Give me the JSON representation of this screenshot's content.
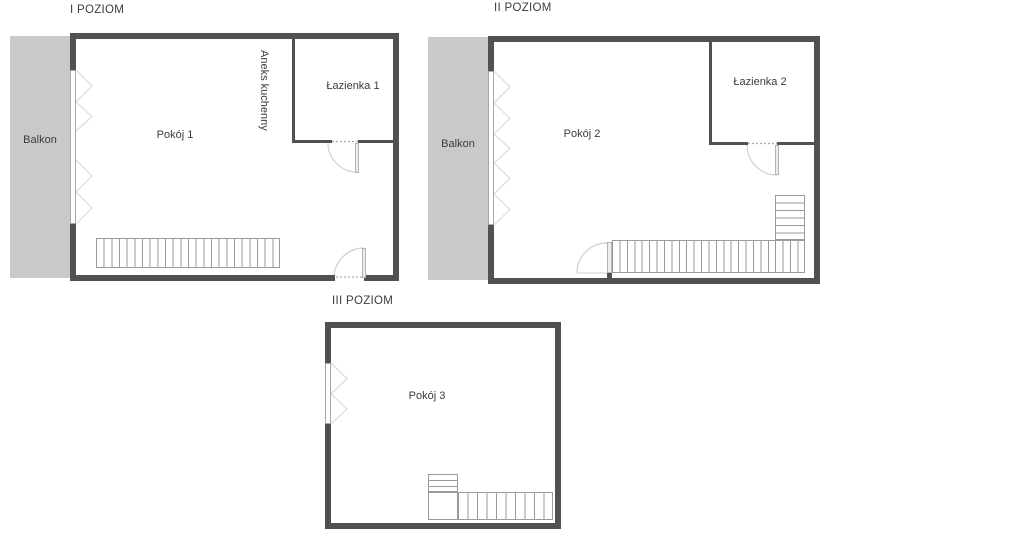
{
  "colors": {
    "wall": "#515151",
    "balcony": "#c9c9c9",
    "stairs": "#9a9a9a",
    "door": "#d0d0d0",
    "window": "#a6a6a6",
    "text": "#3c3c3c"
  },
  "levels": [
    {
      "title": "I POZIOM",
      "balcony_label": "Balkon",
      "room_label": "Pokój 1",
      "kitchen_label": "Aneks kuchenny",
      "bathroom_label": "Łazienka 1"
    },
    {
      "title": "II POZIOM",
      "balcony_label": "Balkon",
      "room_label": "Pokój 2",
      "bathroom_label": "Łazienka 2"
    },
    {
      "title": "III POZIOM",
      "room_label": "Pokój 3"
    }
  ]
}
